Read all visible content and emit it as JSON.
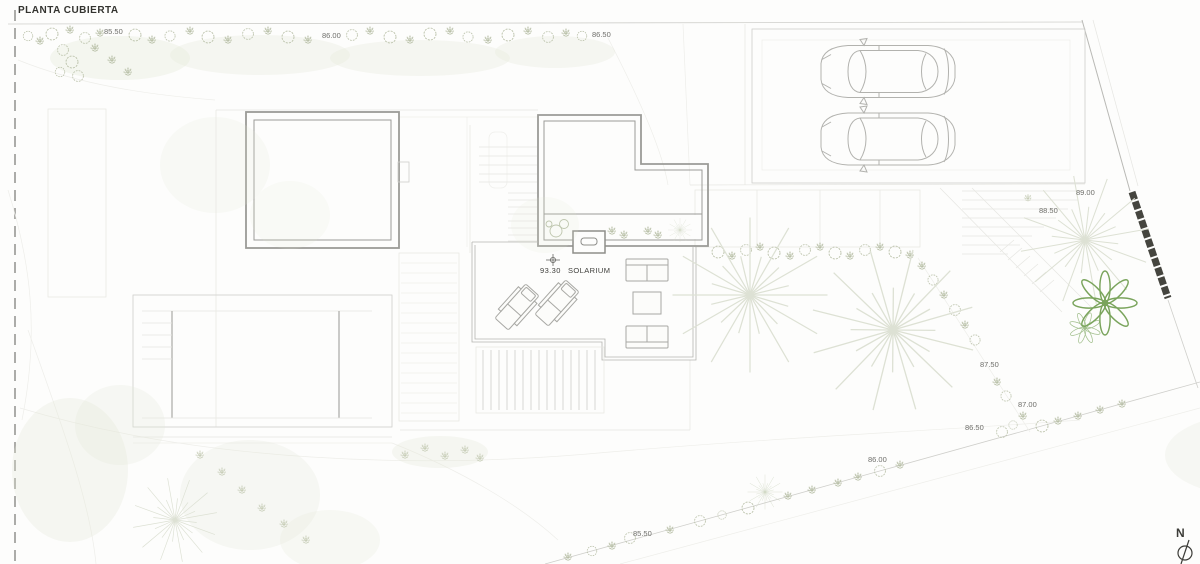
{
  "title": "PLANTA CUBIERTA",
  "solarium": {
    "level": "93.30",
    "name": "SOLARIUM"
  },
  "north": {
    "label": "N"
  },
  "elevations": {
    "top_85_50": "85.50",
    "top_86_00": "86.00",
    "top_86_50": "86.50",
    "right_89_00": "89.00",
    "right_88_50": "88.50",
    "right_87_50": "87.50",
    "right_87_00": "87.00",
    "right_86_50": "86.50",
    "right_86_00": "86.00",
    "bottom_85_50": "85.50"
  },
  "colors": {
    "background": "#fdfdfc",
    "roof_outline": "#9b9b97",
    "roof_fill": "#f5f5f2",
    "faint_line": "#e6e6e2",
    "vegetation": "#b9c0a8",
    "plant_green": "#7aa45c",
    "retaining_wall": "#45453f",
    "title_text": "#33332f",
    "label_text": "#6f6f6b"
  }
}
